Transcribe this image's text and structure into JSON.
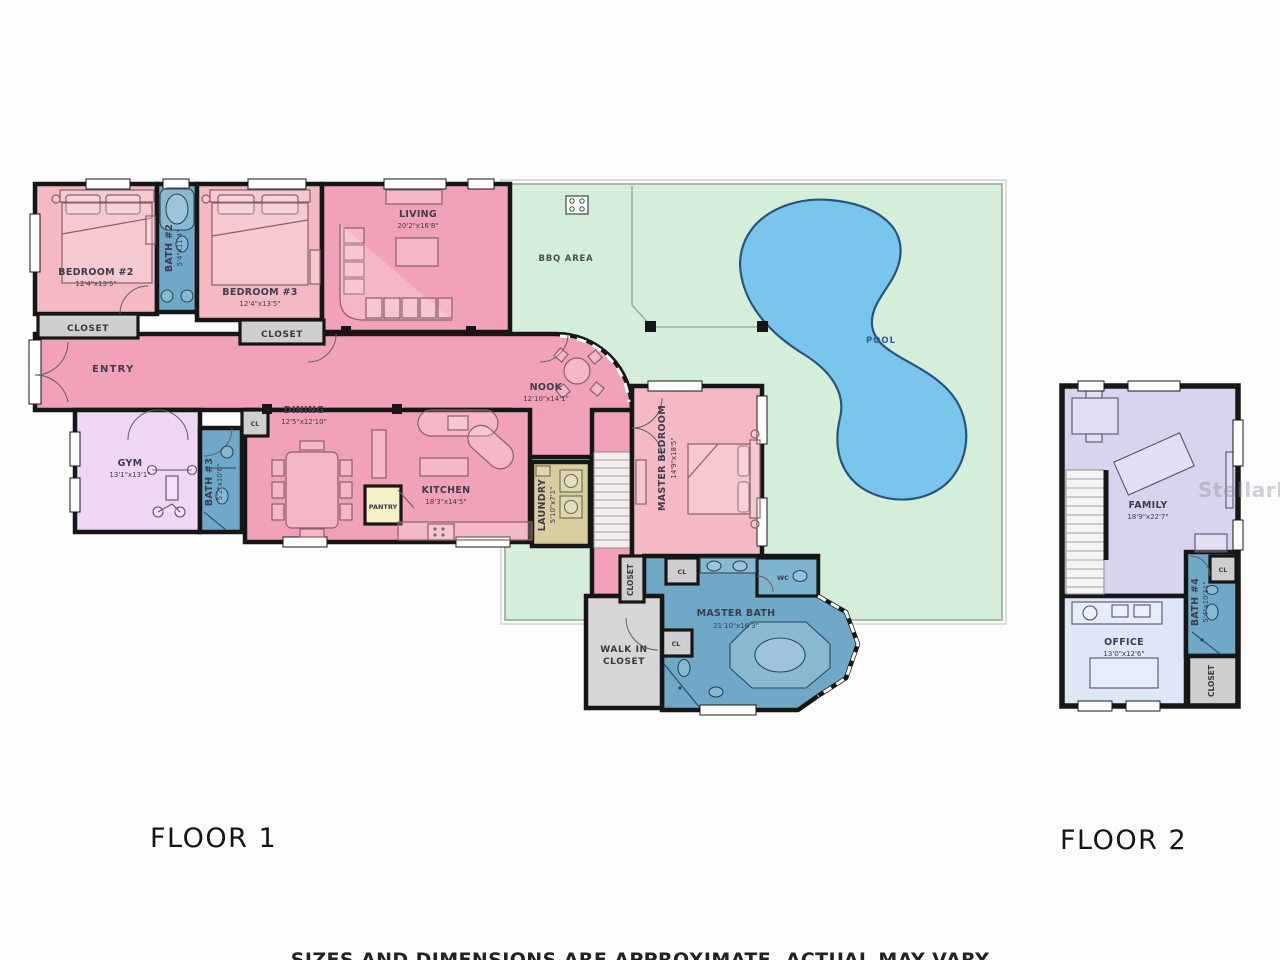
{
  "floor1": {
    "label": "FLOOR 1",
    "rooms": {
      "bedroom2": {
        "name": "BEDROOM #2",
        "dims": "12'4\"x13'5\""
      },
      "bath2": {
        "name": "BATH #2",
        "dims": "5'4\"x11'4\""
      },
      "bedroom3": {
        "name": "BEDROOM #3",
        "dims": "12'4\"x13'5\""
      },
      "closet_bed2": {
        "name": "CLOSET"
      },
      "closet_bed3": {
        "name": "CLOSET"
      },
      "living": {
        "name": "LIVING",
        "dims": "20'2\"x16'8\""
      },
      "bbq": {
        "name": "BBQ AREA"
      },
      "pool": {
        "name": "POOL"
      },
      "entry": {
        "name": "ENTRY"
      },
      "gym": {
        "name": "GYM",
        "dims": "13'1\"x13'1\""
      },
      "bath3": {
        "name": "BATH #3",
        "dims": "5'2\"x10'6\""
      },
      "cl_hall": {
        "name": "CL"
      },
      "dining": {
        "name": "DINING",
        "dims": "12'5\"x12'10\""
      },
      "kitchen": {
        "name": "KITCHEN",
        "dims": "18'3\"x14'5\""
      },
      "pantry": {
        "name": "PANTRY"
      },
      "nook": {
        "name": "NOOK",
        "dims": "12'10\"x14'1\""
      },
      "laundry": {
        "name": "LAUNDRY",
        "dims": "5'10\"x7'1\""
      },
      "master_bedroom": {
        "name": "MASTER BEDROOM",
        "dims": "14'9\"x18'5\""
      },
      "hall_closet": {
        "name": "CLOSET"
      },
      "master_bath": {
        "name": "MASTER BATH",
        "dims": "21'10\"x16'3\""
      },
      "wc": {
        "name": "WC"
      },
      "cl_top": {
        "name": "CL"
      },
      "cl_mid": {
        "name": "CL"
      },
      "walkin": {
        "line1": "WALK IN",
        "line2": "CLOSET"
      }
    }
  },
  "floor2": {
    "label": "FLOOR 2",
    "rooms": {
      "family": {
        "name": "FAMILY",
        "dims": "18'9\"x22'7\""
      },
      "bath4": {
        "name": "BATH #4",
        "dims": "5'4\"x10'11\""
      },
      "cl": {
        "name": "CL"
      },
      "office": {
        "name": "OFFICE",
        "dims": "13'0\"x12'6\""
      },
      "closet": {
        "name": "CLOSET"
      }
    }
  },
  "watermark": "StellarMLS",
  "disclaimer": "SIZES AND DIMENSIONS ARE APPROXIMATE, ACTUAL MAY VARY",
  "colors": {
    "wall": "#161616",
    "pink_main": "#f2a2b8",
    "pink_light": "#f4b9c3",
    "bath_blue": "#6fa9c7",
    "wc_blue": "#7fb4d0",
    "outdoor_green": "#d5eeda",
    "pool_blue": "#79c5ec",
    "gym_lilac": "#eed7f3",
    "pantry_cream": "#f4efc5",
    "laundry_khaki": "#d6ce9e",
    "closet_gray": "#cfcfcf",
    "family_lavender": "#d8d4ee",
    "office_blue": "#dde7f5"
  }
}
